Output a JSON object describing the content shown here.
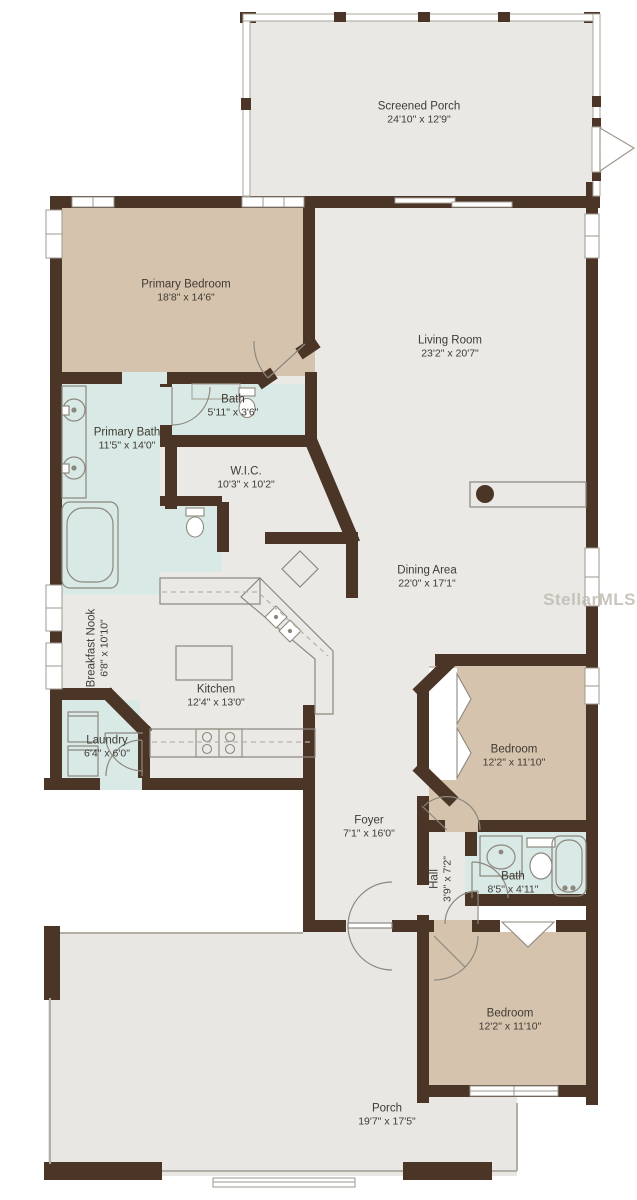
{
  "watermark": "StellarMLS",
  "colors": {
    "wall": "#4b3527",
    "bedroom_floor": "#d5c3ae",
    "bath_floor": "#d9e9e6",
    "living_floor": "#eae9e5",
    "porch_floor": "#e8e7e3"
  },
  "rooms": {
    "screened_porch": {
      "name": "Screened Porch",
      "dims": "24'10\" x 12'9\""
    },
    "primary_bedroom": {
      "name": "Primary Bedroom",
      "dims": "18'8\" x 14'6\""
    },
    "living_room": {
      "name": "Living Room",
      "dims": "23'2\" x 20'7\""
    },
    "bath_primary_wc": {
      "name": "Bath",
      "dims": "5'11\" x 3'6\""
    },
    "primary_bath": {
      "name": "Primary Bath",
      "dims": "11'5\" x 14'0\""
    },
    "wic": {
      "name": "W.I.C.",
      "dims": "10'3\" x 10'2\""
    },
    "dining_area": {
      "name": "Dining Area",
      "dims": "22'0\" x 17'1\""
    },
    "breakfast_nook": {
      "name": "Breakfast Nook",
      "dims": "6'8\" x 10'10\""
    },
    "kitchen": {
      "name": "Kitchen",
      "dims": "12'4\" x 13'0\""
    },
    "laundry": {
      "name": "Laundry",
      "dims": "6'4\" x 6'0\""
    },
    "bedroom_mid": {
      "name": "Bedroom",
      "dims": "12'2\" x 11'10\""
    },
    "foyer": {
      "name": "Foyer",
      "dims": "7'1\" x 16'0\""
    },
    "hall": {
      "name": "Hall",
      "dims": "3'9\" x 7'2\""
    },
    "bath_hall": {
      "name": "Bath",
      "dims": "8'5\" x 4'11\""
    },
    "bedroom_bottom": {
      "name": "Bedroom",
      "dims": "12'2\" x 11'10\""
    },
    "porch": {
      "name": "Porch",
      "dims": "19'7\" x 17'5\""
    }
  }
}
